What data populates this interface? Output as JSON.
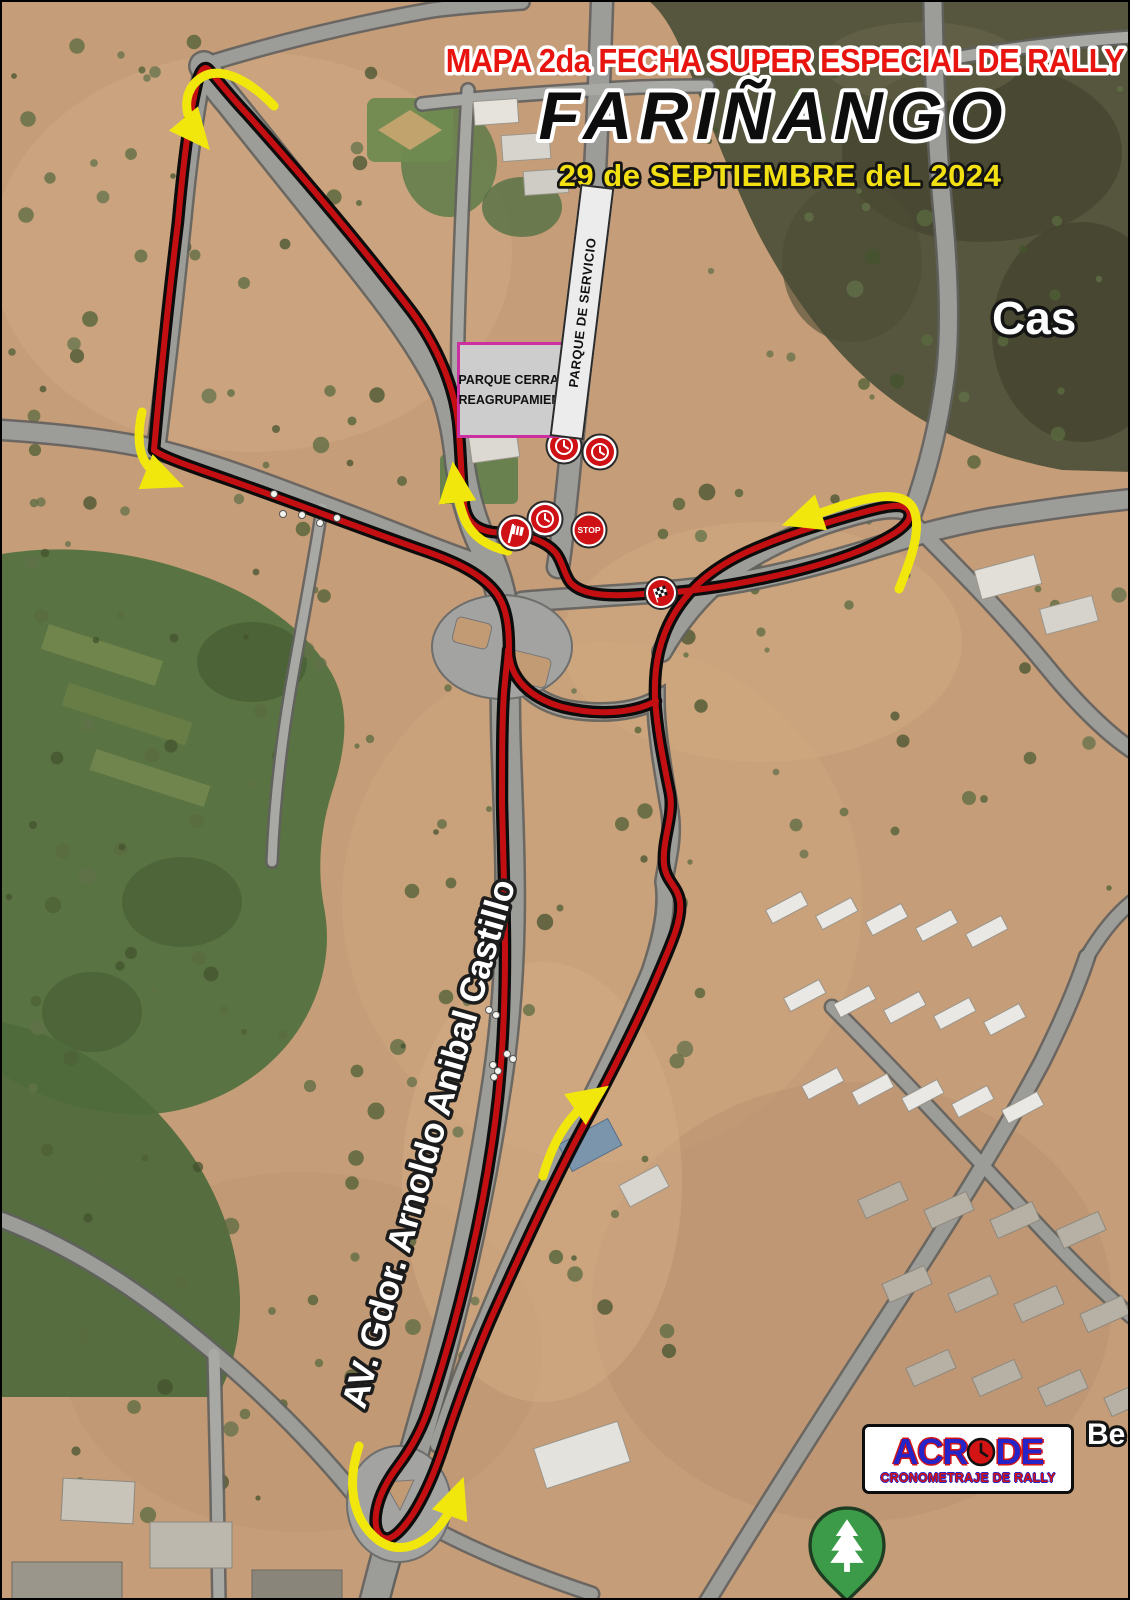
{
  "header": {
    "title_line1": "MAPA 2da FECHA SUPER ESPECIAL DE RALLY",
    "title_line2": "FARIÑANGO",
    "title_line3": "29 de SEPTIEMBRE deL 2024"
  },
  "map_labels": {
    "parque_cerrado_line1": "PARQUE CERRADO",
    "parque_cerrado_line2": "REAGRUPAMIENTO",
    "parque_servicio": "PARQUE DE SERVICIO",
    "street_avenue": "AV. Gdor. Arnoldo Anibal Castillo",
    "place_right_edge": "Cas",
    "place_bottom_right": "Be"
  },
  "markers": {
    "stop_label": "STOP"
  },
  "logo": {
    "name_part1": "ACR",
    "name_part2": "DE",
    "tagline": "CRONOMETRAJE DE RALLY"
  },
  "colors": {
    "track_red": "#c40f12",
    "arrow_yellow": "#f2e70c",
    "title_red": "#e8140f",
    "title_yellow": "#f2e013",
    "logo_blue": "#2424c8",
    "logo_red": "#d41414",
    "pin_green": "#3c9b49",
    "parque_border_magenta": "#cc2fa0"
  }
}
